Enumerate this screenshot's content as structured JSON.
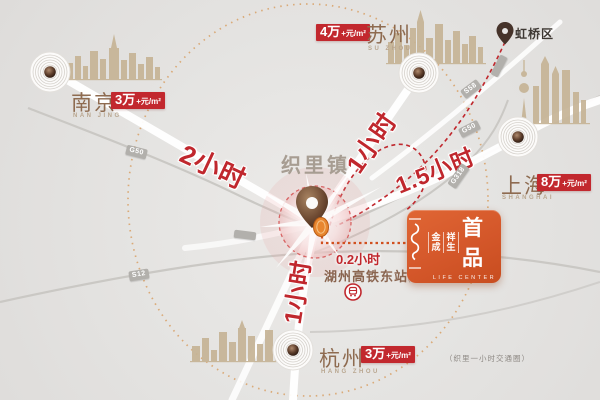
{
  "town": {
    "name": "织里镇"
  },
  "district": {
    "name": "虹桥区"
  },
  "station": {
    "time": "0.2小时",
    "name": "湖州高铁东站",
    "status": "(规划中)"
  },
  "cities": {
    "nanjing": {
      "name": "南京",
      "pinyin": "NAN JING",
      "price_value": "3万",
      "price_unit": "+元/m²",
      "travel_time": "2小时"
    },
    "suzhou": {
      "name": "苏州",
      "pinyin": "SU ZHOU",
      "price_value": "4万",
      "price_unit": "+元/m²",
      "travel_time": "1小时"
    },
    "shanghai": {
      "name": "上海",
      "pinyin": "SHANGHAI",
      "price_value": "8万",
      "price_unit": "+元/m²",
      "travel_time": "1.5小时"
    },
    "hangzhou": {
      "name": "杭州",
      "pinyin": "HANG ZHOU",
      "price_value": "3万",
      "price_unit": "+元/m²",
      "travel_time": "1小时"
    }
  },
  "roads": {
    "g50_left": "G50",
    "s12": "S12",
    "s58": "S58",
    "g50_right": "G50",
    "g318": "G318"
  },
  "logo": {
    "brand_col1_top": "金",
    "brand_col1_bottom": "成",
    "brand_col2_top": "祥",
    "brand_col2_bottom": "生",
    "product": "首品",
    "subtitle": "LIFE CENTER"
  },
  "note": "（织里一小时交通圈）",
  "colors": {
    "accent_red": "#c0272d",
    "brand_orange": "#d4572a",
    "map_background": "#e5e4e2",
    "skyline_tan": "#c6b496",
    "dotted_ring": "#d8a36b"
  }
}
